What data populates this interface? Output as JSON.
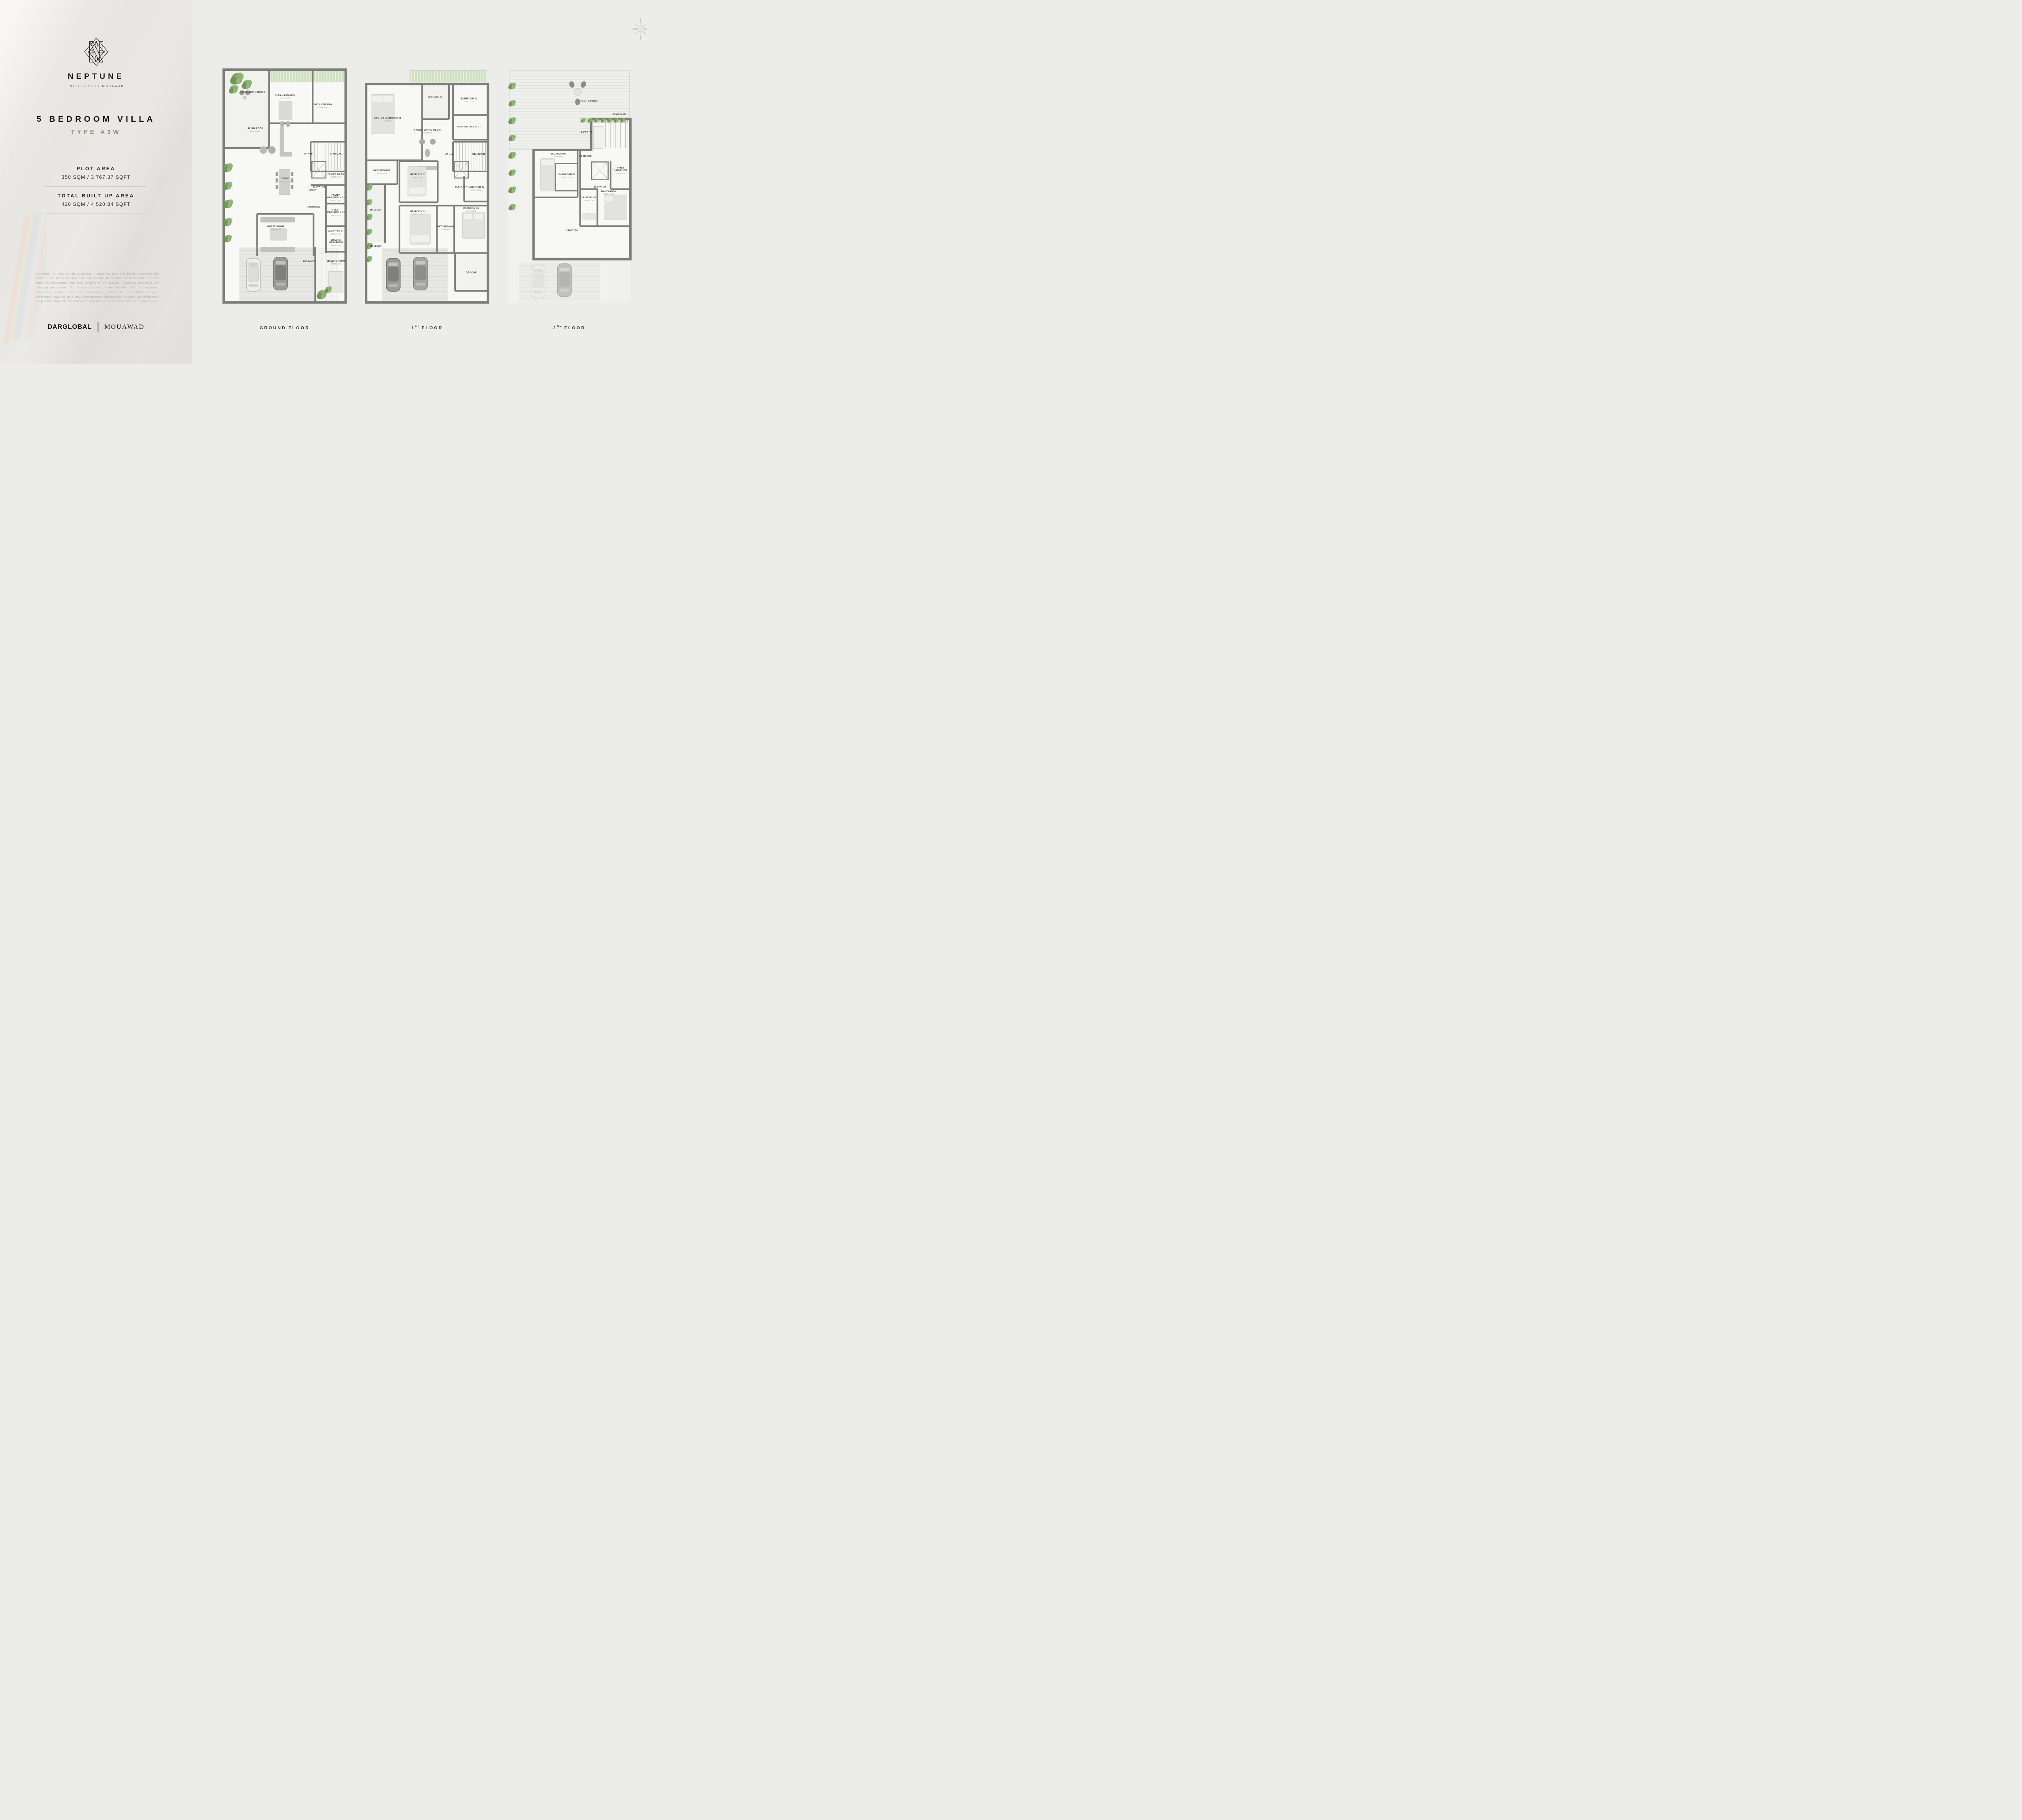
{
  "brand": {
    "name": "NEPTUNE",
    "tagline": "INTERIORS BY MOUAWAD"
  },
  "unit": {
    "title": "5 BEDROOM VILLA",
    "type": "TYPE A3W"
  },
  "areas": {
    "plot_label": "PLOT AREA",
    "plot_value": "350 SQM / 3,767.37 SQFT",
    "bua_label": "TOTAL BUILT UP AREA",
    "bua_value": "420 SQM / 4,520.84 SQFT"
  },
  "disclaimer": "Disclaimer: All pictures, plans, layouts, information, data and details included in this brochure are indicative only and may change at any time up to the final 'as built' status in accordance with final designs of the project, regulatory approvals and planning permissions. All accessories and interior finishes such as wallpaper, chandeliers, furniture, electronics, white goods, curtains, hard and soft landscaping, pavements, features, gym, and other elements displayed in the brochure, or between the plot boundary, are not part of the unit and are shown for illustrative purposes only.",
  "footer": {
    "developer": "DARGLOBAL",
    "separator": "|",
    "interiors": "MOUAWAD"
  },
  "colors": {
    "accent": "#8F8A71",
    "wall": "#7D7D7A",
    "left_bg": "#E7E5E2",
    "right_bg": "#ECECEA",
    "plan_bg": "#F8F8F6",
    "green": "#7FA465"
  },
  "floors": {
    "ground": {
      "caption_prefix": "GROUND",
      "caption_sup": "",
      "caption_suffix": "FLOOR",
      "rooms": {
        "backyard": {
          "l1": "BACKYARD GARDEN"
        },
        "clean_kitchen": {
          "l1": "CLEAN KITCHEN",
          "dims": "3450X2150"
        },
        "dirty_kitchen": {
          "l1": "DIRTY KITCHEN",
          "dims": "3700X3800"
        },
        "living": {
          "l1": "LIVING ROOM",
          "dims": "7500X5250"
        },
        "up": {
          "l1": "UP"
        },
        "staircase": {
          "l1": "STAIRCASE"
        },
        "elevator": {
          "l1": "ELEVATOR"
        },
        "family_wc": {
          "l1": "FAMILY WC 01",
          "dims": "1550X1650"
        },
        "dining": {
          "l1": "DINING",
          "dims": "5080 X 3870"
        },
        "lobby": {
          "l1": "LOBBY"
        },
        "family_wash": {
          "l1": "FAMILY",
          "l2": "WASH ROOM 01",
          "dims": "1850X1900"
        },
        "entrance": {
          "l1": "ENTRANCE"
        },
        "guest_wash": {
          "l1": "GUEST",
          "l2": "WASH ROOM 01",
          "dims": "1950X2950"
        },
        "guest_wc": {
          "l1": "GUEST WC 01",
          "dims": "1550X1750"
        },
        "guest_room": {
          "l1": "GUEST ROOM",
          "dims": "5950X4450"
        },
        "drivers_wash": {
          "l1": "DRIVERS",
          "l2": "WASHROOM",
          "dims": "1550X2300"
        },
        "entrance_drive": {
          "l1": "ENTRANCE"
        },
        "drivers_room": {
          "l1": "DRIVERS ROOM",
          "dims": "2250X2800"
        }
      }
    },
    "first": {
      "caption_prefix": "1",
      "caption_sup": "ST",
      "caption_suffix": "FLOOR",
      "rooms": {
        "master": {
          "l1": "MASTER BEDROOM 01",
          "dims": "4850X3800"
        },
        "terrace": {
          "l1": "TERRACE 01"
        },
        "bathroom01": {
          "l1": "BATHROOM 01",
          "dims": "3200X1600"
        },
        "dressing": {
          "l1": "DRESSING ROOM 01"
        },
        "family_living": {
          "l1": "FAMILY LIVING ROOM",
          "dims": "3600X3300"
        },
        "up": {
          "l1": "UP"
        },
        "staircase": {
          "l1": "STAIRCASE"
        },
        "elevator": {
          "l1": "ELEVATOR"
        },
        "bathroom02": {
          "l1": "BATHROOM 02",
          "dims": "2400X1640"
        },
        "bedroom02": {
          "l1": "BEDROOM 02",
          "dims": "3950X3850"
        },
        "balcony_upper": {
          "l1": "BALCONY"
        },
        "bathroom04": {
          "l1": "BATHROOM 04",
          "dims": "1500X3300"
        },
        "bedroom03": {
          "l1": "BEDROOM 03",
          "dims": "3850X4450"
        },
        "bathroom03": {
          "l1": "BATHROOM 03",
          "dims": "1600X2850"
        },
        "bedroom04": {
          "l1": "BEDROOM 04",
          "dims": "3400X4900"
        },
        "balcony_lower": {
          "l1": "BALCONY"
        },
        "gf_roof": {
          "l1": "GF-ROOF"
        }
      }
    },
    "second": {
      "caption_prefix": "2",
      "caption_sup": "ND",
      "caption_suffix": "FLOOR",
      "rooms": {
        "roof_garden": {
          "l1": "ROOF GARDEN"
        },
        "down": {
          "l1": "DOWN"
        },
        "staircase": {
          "l1": "STAIRCASE"
        },
        "corridor": {
          "l1": "CORRIDOR"
        },
        "bedroom05": {
          "l1": "BEDROOM 05",
          "dims": "2850X4300"
        },
        "bathroom05": {
          "l1": "BATHROOM 05",
          "dims": "2050X1800"
        },
        "elevator": {
          "l1": "ELEVATOR"
        },
        "maids_bath": {
          "l1": "MAIDS",
          "l2": "BATHROOM",
          "dims": "1550X1400"
        },
        "maids_room": {
          "l1": "MAIDS ROOM",
          "dims": "2750X2600"
        },
        "laundry": {
          "l1": "LAUNDRY 01",
          "dims": "1850X1200"
        },
        "utilities": {
          "l1": "UTILITIES"
        }
      }
    }
  }
}
